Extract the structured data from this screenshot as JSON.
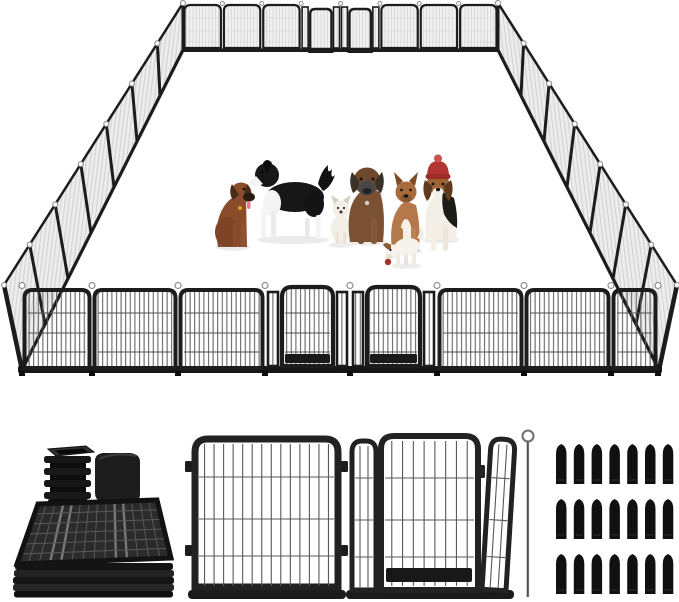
{
  "page": {
    "title": "Heavy-duty metal dog playpen product image with seven dogs inside and parts shown below",
    "background_color": "#ffffff"
  },
  "playpen_scene": {
    "description": "Assembled 24-panel metal mesh dog playpen drawn in perspective as a large rectangle",
    "frame_color": "#1c1c1c",
    "wire_color": "#4f4f4f",
    "connector_loop_color": "#8d8d8d",
    "mesh_far_color": "#f0f0f0",
    "walls": {
      "back": {
        "panels": 8,
        "gate_panels": 2
      },
      "front": {
        "panels": 8,
        "gate_panels": 2
      },
      "left": {
        "panels": 7
      },
      "right": {
        "panels": 7
      }
    },
    "dogs": [
      {
        "id": "brown-dog-sitting",
        "pose": "sitting",
        "fur_color": "#8a4c2a",
        "detail": "tongue out, black muzzle"
      },
      {
        "id": "black-white-dog-standing",
        "pose": "standing",
        "fur_color": "#171717",
        "accent_color": "#f4f4f4",
        "detail": "bushy raised tail, white chest and legs"
      },
      {
        "id": "small-white-dog-sitting",
        "pose": "sitting",
        "fur_color": "#f3efe6"
      },
      {
        "id": "brown-mastiff-sitting",
        "pose": "sitting",
        "fur_color": "#7b5134",
        "accent_color": "#474749",
        "detail": "gray face mask, floppy dark ears"
      },
      {
        "id": "tan-dog-sitting",
        "pose": "sitting",
        "fur_color": "#b5784a",
        "accent_color": "#f6f1e8",
        "detail": "white chest stripe, upright ears"
      },
      {
        "id": "white-puppy-standing",
        "pose": "standing head lowered",
        "fur_color": "#f6f3ec",
        "accent_color": "#a23327",
        "detail": "red toy at mouth, brown ear patch"
      },
      {
        "id": "beagle-with-red-hat",
        "pose": "sitting",
        "fur_color": "#9c6435",
        "accent_color": "#b23430",
        "detail": "red knit hat with pom, tricolor coat"
      }
    ]
  },
  "components": {
    "end_caps": {
      "description": "black square plastic end caps, one ribbed stack and one smooth cap",
      "ribbed_stack_count": 4,
      "color": "#161616"
    },
    "folded_panels": {
      "description": "flat-folded mesh panels stacked for storage, viewed from above-front",
      "color": "#2b2b2b"
    },
    "single_panel": {
      "description": "one fence panel shown from the front with rounded top corners",
      "frame_color": "#222222",
      "wire_color": "#585858"
    },
    "gate_panel": {
      "description": "panel with walk-through gate flanked by two narrow side sections",
      "frame_color": "#222222",
      "threshold_color": "#181818"
    },
    "ground_rod": {
      "description": "long anchor rod with loop handle at top",
      "color": "#707070"
    },
    "stakes": {
      "description": "black ground stakes laid out in a grid",
      "rows": 3,
      "columns": 7,
      "total": 21,
      "color": "#101010"
    }
  }
}
